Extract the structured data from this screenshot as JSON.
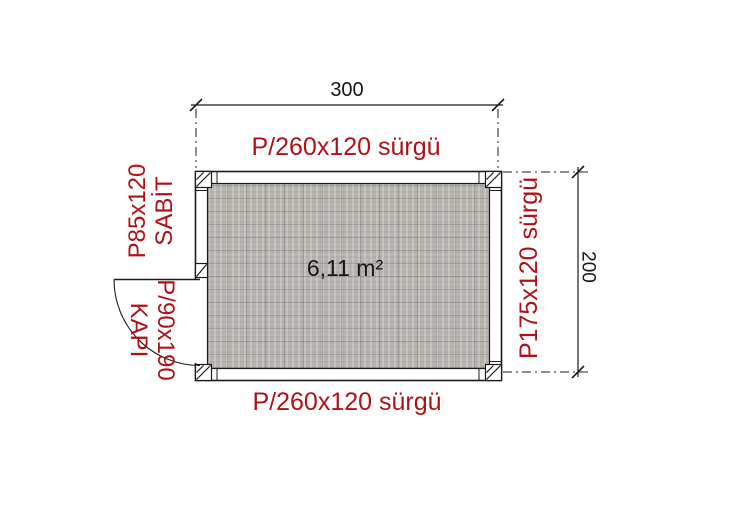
{
  "plan": {
    "area_label": "6,11 m²",
    "dimensions": {
      "width": "300",
      "height": "200"
    },
    "windows": {
      "top": "P/260x120 sürgü",
      "bottom": "P/260x120 sürgü",
      "left_line1": "P85x120",
      "left_line2": "SABİT",
      "right": "P175x120 sürgü"
    },
    "door": {
      "line1": "P/90x190",
      "line2": "KAPI"
    },
    "colors": {
      "label_red": "#b01116",
      "line_black": "#1c1c1c",
      "floor_gray": "#b7b5b1"
    }
  }
}
